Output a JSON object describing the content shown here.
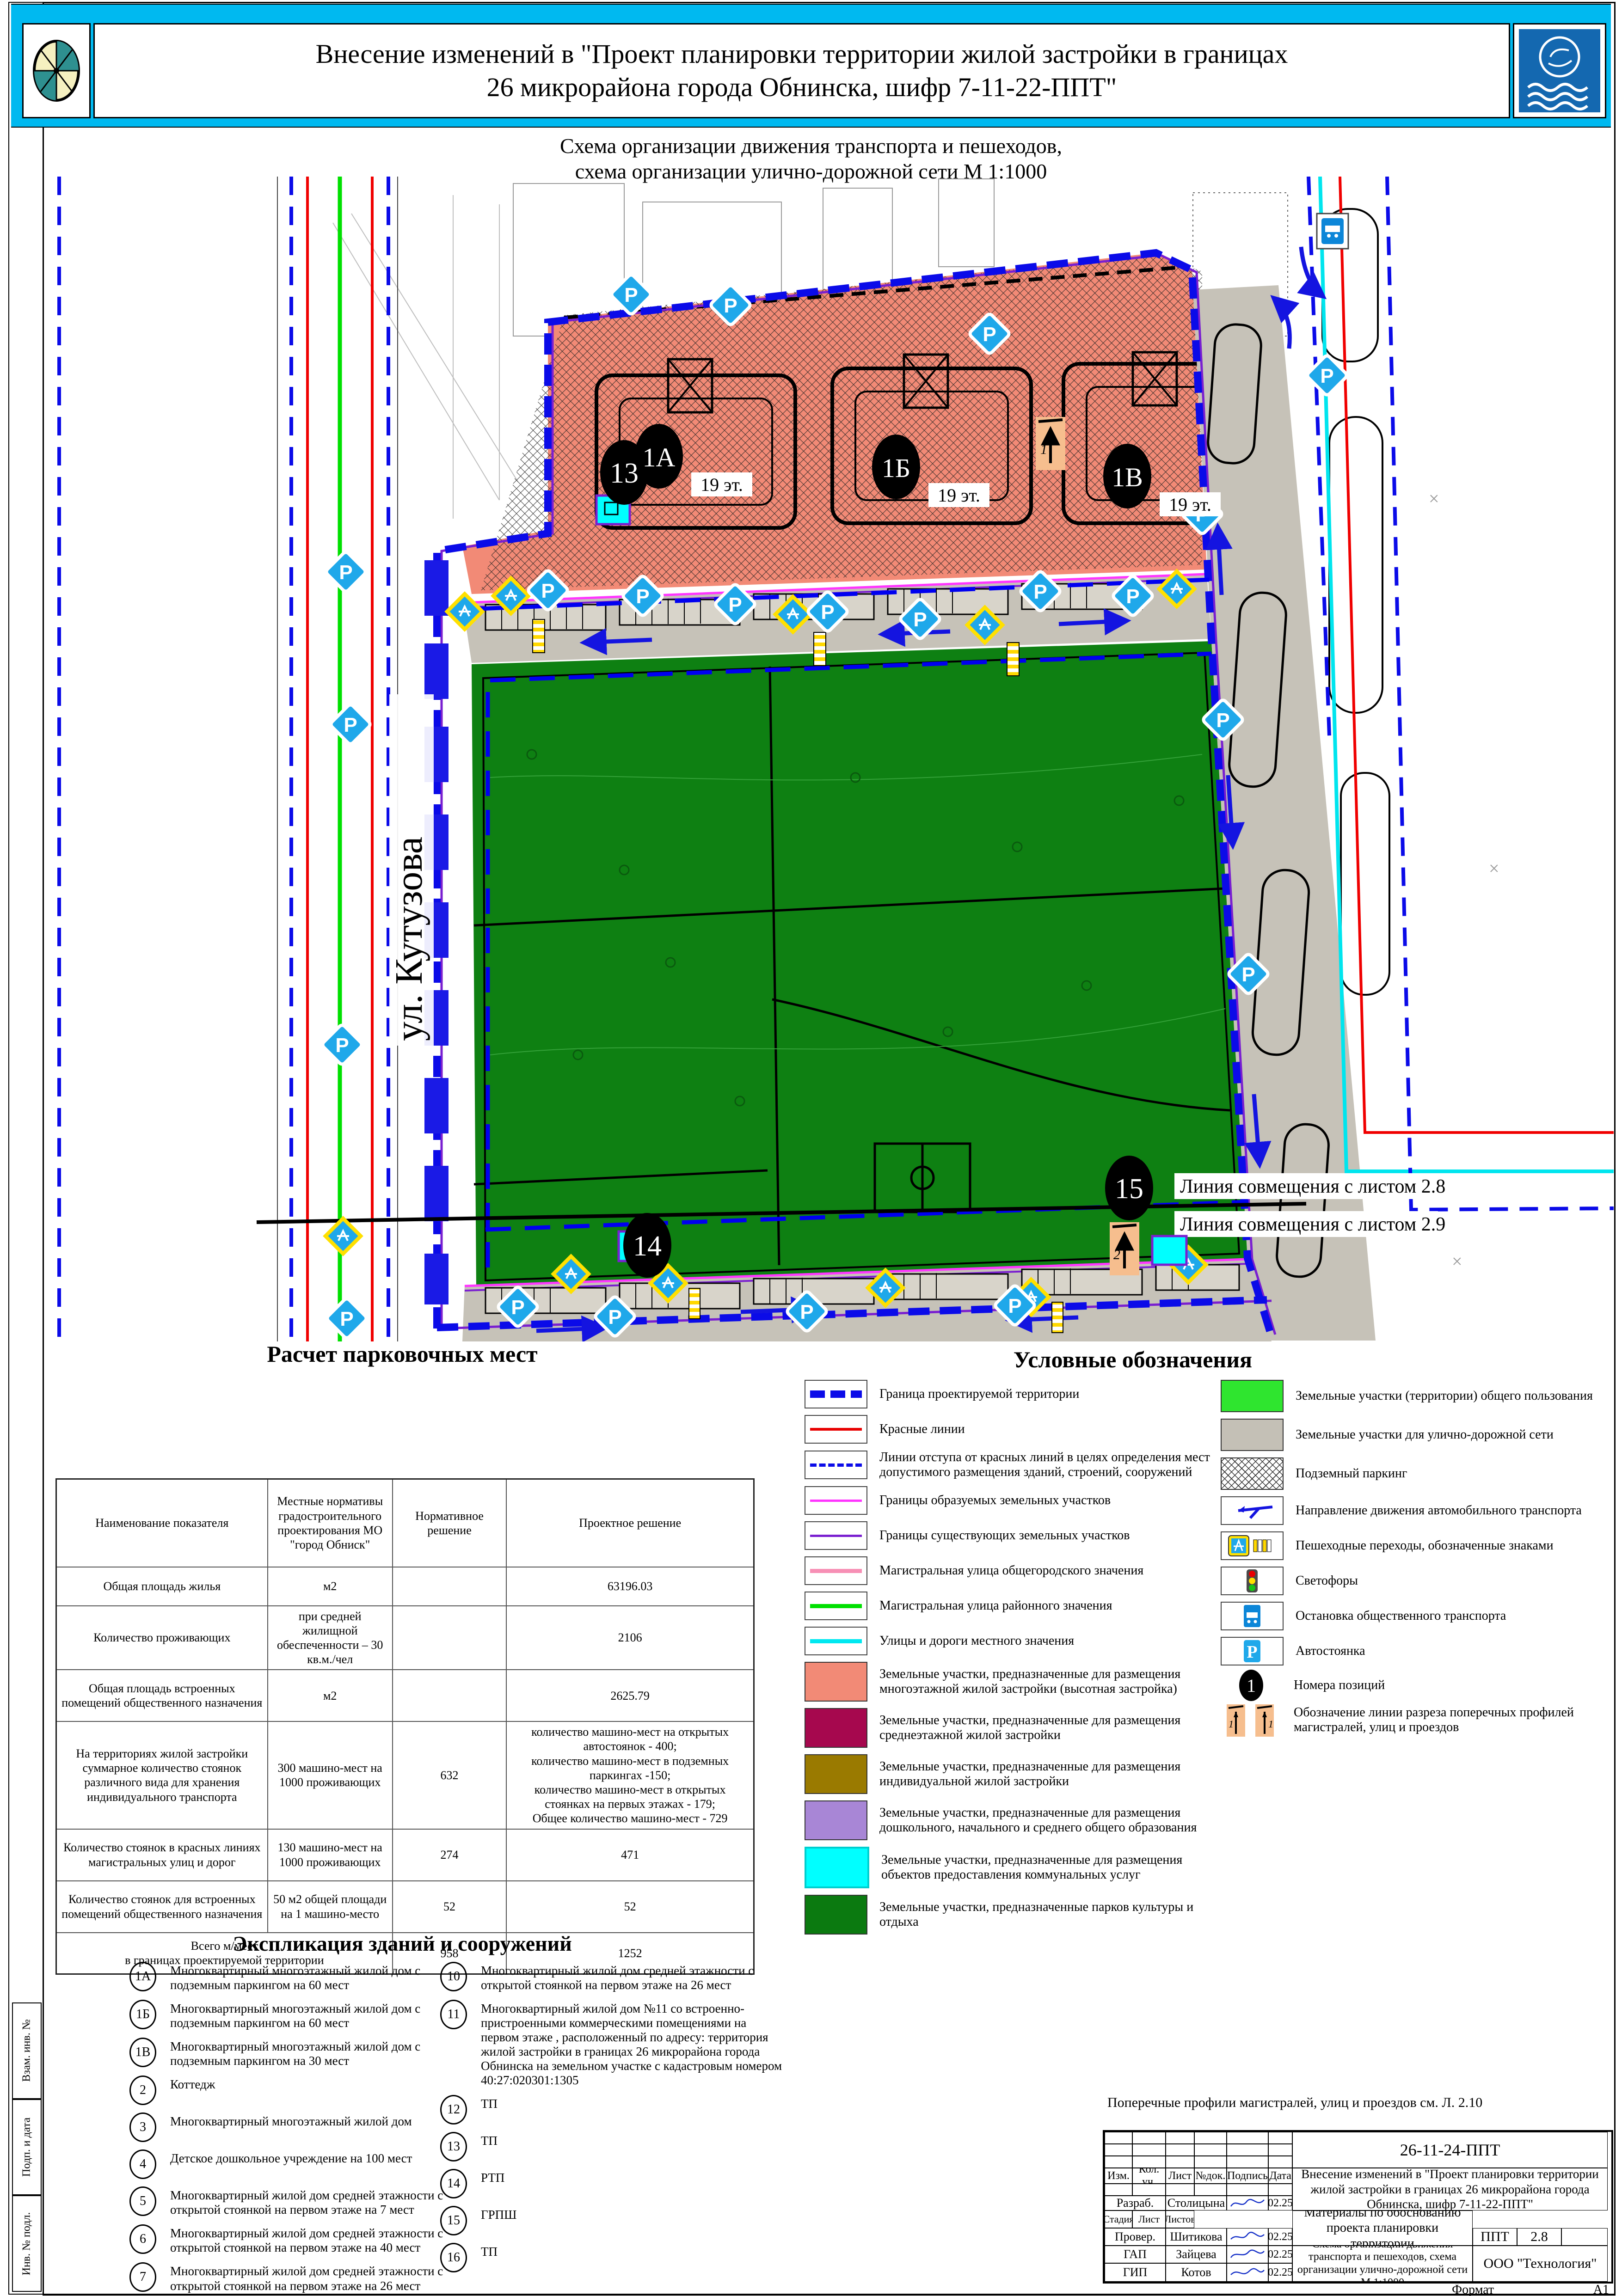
{
  "header": {
    "title_line1": "Внесение изменений в \"Проект планировки территории жилой застройки  в границах",
    "title_line2": "26 микрорайона города Обнинска, шифр 7-11-22-ППТ\"",
    "subtitle_line1": "Схема организации движения транспорта и пешеходов,",
    "subtitle_line2": "схема организации улично-дорожной сети М 1:1000"
  },
  "map": {
    "street_label": "ул. Кутузова",
    "match_line_top": "Линия совмещения с листом 2.8",
    "match_line_bottom": "Линия совмещения с листом 2.9",
    "parking_letter": "P",
    "buildings": [
      {
        "id": "1А",
        "floors": "19 эт."
      },
      {
        "id": "1Б",
        "floors": "19 эт."
      },
      {
        "id": "1В",
        "floors": "19 эт."
      }
    ],
    "positions": {
      "p13": "13",
      "p14": "14",
      "p15": "15"
    },
    "section_markers": [
      "1",
      "2"
    ]
  },
  "parking_table": {
    "title": "Расчет парковочных мест",
    "col_headers": [
      "Наименование показателя",
      "Местные нормативы градостроительного проектирования МО \"город Обниск\"",
      "Нормативное решение",
      "Проектное решение"
    ],
    "rows": [
      {
        "name": "Общая площадь жилья",
        "norm": "м2",
        "normative": "",
        "project": "63196.03"
      },
      {
        "name": "Количество проживающих",
        "norm": "при средней жилищной обеспеченности – 30 кв.м./чел",
        "normative": "",
        "project": "2106"
      },
      {
        "name": "Общая площадь встроенных помещений общественного назначения",
        "norm": "м2",
        "normative": "",
        "project": "2625.79"
      },
      {
        "name": "На территориях жилой застройки суммарное количество стоянок различного вида для хранения индивидуального транспорта",
        "norm": "300 машино-мест на 1000 проживающих",
        "normative": "632",
        "project": "количество машино-мест на открытых автостоянок - 400;\nколичество машино-мест в подземных паркингах -150;\nколичество машино-мест в открытых стоянках на первых этажах - 179;\nОбщее количество машино-мест - 729"
      },
      {
        "name": "Количество стоянок в красных линиях магистральных улиц и дорог",
        "norm": "130 машино-мест на 1000 проживающих",
        "normative": "274",
        "project": "471"
      },
      {
        "name": "Количество стоянок для встроенных помещений общественного назначения",
        "norm": "50 м2 общей площади на 1 машино-место",
        "normative": "52",
        "project": "52"
      },
      {
        "name": "Всего м/мест\nв границах проектируемой территории",
        "norm": "",
        "normative": "958",
        "project": "1252"
      }
    ]
  },
  "legend": {
    "title": "Условные обозначения",
    "left": [
      {
        "icon": "boundary-line",
        "label": "Граница проектируемой территории"
      },
      {
        "icon": "red-line",
        "label": "Красные линии"
      },
      {
        "icon": "setback-dashed-line",
        "label": "Линии отступа от красных линий в целях определения мест допустимого размещения зданий, строений, сооружений"
      },
      {
        "icon": "magenta-line",
        "label": "Границы образуемых земельных участков"
      },
      {
        "icon": "purple-line",
        "label": "Границы существующих земельных участков"
      },
      {
        "icon": "pink-line",
        "label": "Магистральная улица общегородского значения"
      },
      {
        "icon": "green-line",
        "label": "Магистральная улица районного значения"
      },
      {
        "icon": "cyan-line",
        "label": "Улицы и дороги местного значения"
      },
      {
        "icon": "salmon-fill",
        "label": "Земельные участки, предназначенные для размещения многоэтажной жилой застройки (высотная застройка)"
      },
      {
        "icon": "crimson-fill",
        "label": "Земельные участки, предназначенные для размещения  среднеэтажной жилой застройки"
      },
      {
        "icon": "gold-fill",
        "label": "Земельные участки, предназначенные для размещения индивидуальной жилой застройки"
      },
      {
        "icon": "lilac-fill",
        "label": "Земельные участки, предназначенные для размещения дошкольного, начального и среднего общего образования"
      },
      {
        "icon": "cyan-fill",
        "label": "Земельные участки, предназначенные для размещения объектов  предоставления коммунальных услуг"
      },
      {
        "icon": "darkgreen-fill",
        "label": "Земельные участки, предназначенные парков культуры и отдыха"
      }
    ],
    "right": [
      {
        "icon": "brightgreen-fill",
        "label": "Земельные участки (территории) общего пользования"
      },
      {
        "icon": "gray-fill",
        "label": "Земельные участки для улично-дорожной сети"
      },
      {
        "icon": "crosshatch-fill",
        "label": "Подземный паркинг"
      },
      {
        "icon": "blue-arrow",
        "label": "Направление движения автомобильного транспорта"
      },
      {
        "icon": "crosswalk-sign",
        "label": "Пешеходные переходы, обозначенные знаками"
      },
      {
        "icon": "traffic-light",
        "label": "Светофоры"
      },
      {
        "icon": "bus-stop-sign",
        "label": "Остановка общественного транспорта"
      },
      {
        "icon": "parking-sign",
        "label": "Автостоянка"
      },
      {
        "icon": "position-number",
        "label": "Номера позиций"
      },
      {
        "icon": "section-cut-marker",
        "label": "Обозначение линии разреза поперечных профилей магистралей, улиц и проездов"
      }
    ]
  },
  "explication": {
    "title": "Экспликация зданий и сооружений",
    "left": [
      {
        "num": "1А",
        "text": "Многоквартирный многоэтажный жилой дом с подземным паркингом на 60 мест"
      },
      {
        "num": "1Б",
        "text": "Многоквартирный многоэтажный жилой дом с подземным паркингом на 60 мест"
      },
      {
        "num": "1В",
        "text": "Многоквартирный многоэтажный жилой дом с подземным паркингом на 30 мест"
      },
      {
        "num": "2",
        "text": "Коттедж"
      },
      {
        "num": "3",
        "text": "Многоквартирный  многоэтажный жилой дом"
      },
      {
        "num": "4",
        "text": "Детское дошкольное учреждение на 100 мест"
      },
      {
        "num": "5",
        "text": "Многоквартирный  жилой дом средней этажности с открытой стоянкой на первом этаже на 7 мест"
      },
      {
        "num": "6",
        "text": "Многоквартирный  жилой дом средней этажности с открытой стоянкой на первом этаже на 40 мест"
      },
      {
        "num": "7",
        "text": "Многоквартирный  жилой дом средней этажности с открытой стоянкой на первом этаже на 26 мест"
      },
      {
        "num": "8",
        "text": "Многоквартирный  жилой дом средней этажности с открытой стоянкой на первом этаже на 40 мест"
      },
      {
        "num": "9",
        "text": "Многоквартирный  жилой дом средней этажности с открытой стоянкой на первом этаже на 40 мест"
      }
    ],
    "right": [
      {
        "num": "10",
        "text": "Многоквартирный  жилой дом средней этажности с открытой стоянкой на первом этаже на 26 мест"
      },
      {
        "num": "11",
        "text": "Многоквартирный жилой дом №11 со встроенно-пристроенными коммерческими помещениями на первом этаже , расположенный по адресу: территория жилой застройки в границах 26 микрорайона города Обнинска на земельном участке с кадастровым номером 40:27:020301:1305"
      },
      {
        "num": "12",
        "text": "ТП"
      },
      {
        "num": "13",
        "text": "ТП"
      },
      {
        "num": "14",
        "text": "РТП"
      },
      {
        "num": "15",
        "text": "ГРПШ"
      },
      {
        "num": "16",
        "text": "ТП"
      }
    ]
  },
  "note": "Поперечные профили магистралей, улиц и проездов см. Л. 2.10",
  "stamp": {
    "doc_number": "26-11-24-ППТ",
    "project_title": "Внесение изменений в \"Проект планировки территории жилой застройки в границах 26 микрорайона города Обнинска, шифр 7-11-22-ППТ\"",
    "cols": [
      "Изм.",
      "Кол. уч.",
      "Лист",
      "№док.",
      "Подпись",
      "Дата"
    ],
    "roles": [
      [
        "Разраб.",
        "Столицына",
        "02.25"
      ],
      [
        "Провер.",
        "Шитикова",
        "02.25"
      ],
      [
        "ГАП",
        "Зайцева",
        "02.25"
      ],
      [
        "ГИП",
        "Котов",
        "02.25"
      ],
      [
        "Н.контр.",
        "Котов",
        "02.25"
      ]
    ],
    "section_label": "Материалы по обоснованию проекта планировки территории",
    "stage_headers": [
      "Стадия",
      "Лист",
      "Листов"
    ],
    "stage": "ППТ",
    "sheet_num": "2.8",
    "sheet_title": "Схема организации движения транспорта и пешеходов, схема организации улично-дорожной сети М 1:1000",
    "company": "ООО \"Технология\"",
    "format_label": "Формат",
    "format_value": "А1"
  },
  "frame_labels": [
    "Взам. инв. №",
    "Подп. и дата",
    "Инв. № подл."
  ],
  "colors": {
    "header_band": "#00B9F0",
    "boundary_blue": "#0B0BE8",
    "red_line": "#E80000",
    "park_green": "#0E8012",
    "public_green": "#2FE52F",
    "salmon_zone": "#F28A76",
    "road_gray": "#C6C2B8",
    "crimson_zone": "#A6084E",
    "gold_zone": "#9A7A00",
    "lilac_zone": "#A886D6",
    "utility_cyan": "#00FFFF",
    "sign_blue": "#1FA8EA",
    "magenta_line": "#FF35FF",
    "purple_line": "#7A1FD0"
  }
}
